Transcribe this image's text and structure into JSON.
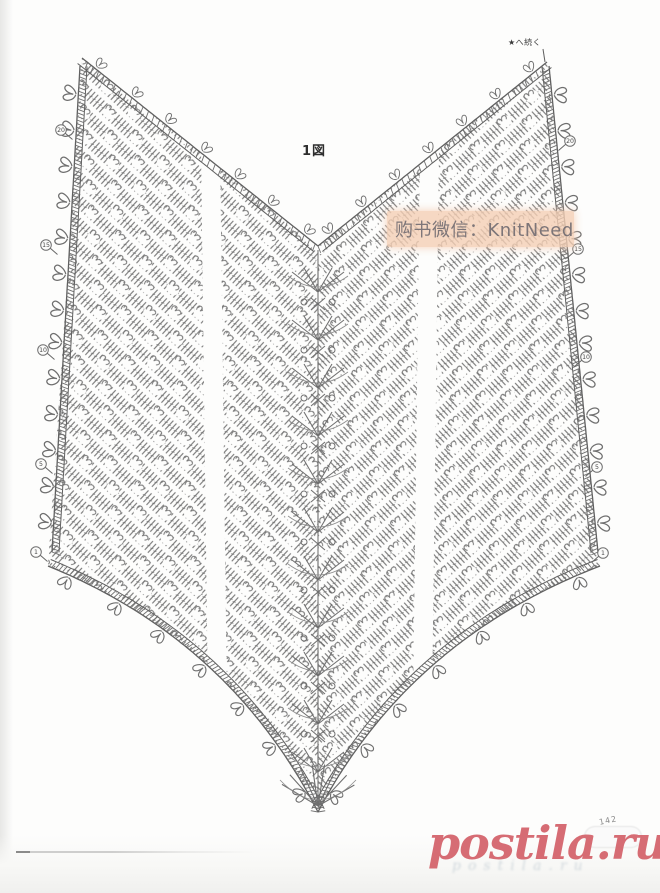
{
  "page": {
    "figure_label": "1図",
    "continuation_note": "★へ続く",
    "page_number": "142"
  },
  "watermark_seller": {
    "text": "购书微信：KnitNeed",
    "band_color": "#f4ceb4",
    "text_color": "#68656c"
  },
  "watermark_site": {
    "text": "postila.ru",
    "color": "#d4626a"
  },
  "chart": {
    "type": "crochet-chart",
    "stitch_color": "#6f6f6f",
    "edge_color": "#5f5f5f",
    "row_markers_left": [
      "20",
      "15",
      "10",
      "5",
      "1"
    ],
    "row_markers_right": [
      "20",
      "15",
      "10",
      "5",
      "1"
    ]
  }
}
